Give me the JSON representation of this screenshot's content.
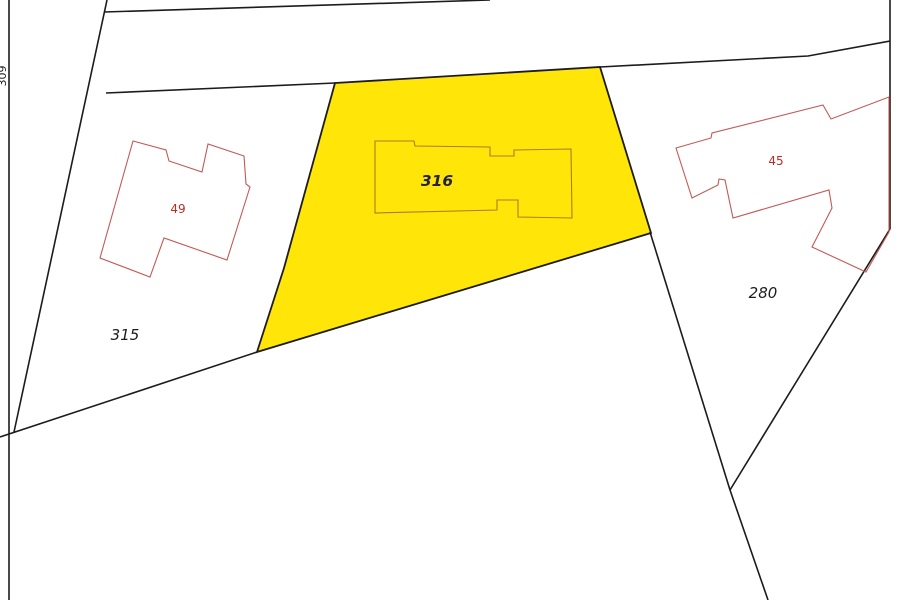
{
  "map": {
    "background": "#ffffff",
    "colors": {
      "boundary": "#1c1c1c",
      "highlight_fill": "#ffe608",
      "building_outline": "#c25a56",
      "building_outline_on_highlight": "#a97d22",
      "building_label": "#bb2d23",
      "parcel_label": "#1c1c1c",
      "highlight_parcel_label": "#23233f"
    },
    "parcels": [
      {
        "name": "parcel-316-highlighted",
        "label": "316",
        "fill": "#ffe608",
        "stroke": "#1c1c1c",
        "stroke_width": 1.8,
        "interactable": true,
        "points": [
          [
            335,
            83
          ],
          [
            600,
            67
          ],
          [
            651,
            233
          ],
          [
            257,
            352
          ],
          [
            284,
            268
          ]
        ]
      },
      {
        "name": "parcel-315",
        "label": "315",
        "fill": "transparent",
        "stroke": "none",
        "stroke_width": 0,
        "interactable": true,
        "points": [
          [
            106,
            93
          ],
          [
            335,
            83
          ],
          [
            284,
            268
          ],
          [
            257,
            352
          ],
          [
            14,
            432
          ]
        ]
      },
      {
        "name": "parcel-280",
        "label": "280",
        "fill": "transparent",
        "stroke": "none",
        "stroke_width": 0,
        "interactable": true,
        "points": [
          [
            600,
            67
          ],
          [
            808,
            56
          ],
          [
            890,
            41
          ],
          [
            890,
            229
          ],
          [
            730,
            490
          ],
          [
            650,
            232
          ]
        ]
      }
    ],
    "boundaries": [
      {
        "name": "boundary-left-border",
        "points": [
          [
            9,
            0
          ],
          [
            9,
            600
          ]
        ]
      },
      {
        "name": "boundary-left-steep-line",
        "points": [
          [
            107,
            0
          ],
          [
            14,
            432
          ]
        ]
      },
      {
        "name": "boundary-top-line",
        "points": [
          [
            104,
            12
          ],
          [
            490,
            0
          ]
        ]
      },
      {
        "name": "boundary-parcel315-top",
        "points": [
          [
            106,
            93
          ],
          [
            335,
            83
          ]
        ]
      },
      {
        "name": "boundary-bottom-left-diagonal",
        "points": [
          [
            0,
            437
          ],
          [
            257,
            352
          ]
        ]
      },
      {
        "name": "boundary-apex-to-right",
        "points": [
          [
            600,
            67
          ],
          [
            808,
            56
          ],
          [
            890,
            41
          ]
        ]
      },
      {
        "name": "boundary-right-border",
        "points": [
          [
            890,
            0
          ],
          [
            890,
            229
          ]
        ]
      },
      {
        "name": "boundary-right-diagonal",
        "points": [
          [
            890,
            229
          ],
          [
            730,
            490
          ]
        ]
      },
      {
        "name": "boundary-parcel280-left",
        "points": [
          [
            650,
            232
          ],
          [
            730,
            490
          ]
        ]
      },
      {
        "name": "boundary-bottom-continuation",
        "points": [
          [
            730,
            490
          ],
          [
            768,
            600
          ]
        ]
      }
    ],
    "buildings": [
      {
        "name": "building-316-outline",
        "stroke": "#a97d22",
        "points": [
          [
            375,
            141
          ],
          [
            414,
            141
          ],
          [
            415,
            146
          ],
          [
            490,
            147
          ],
          [
            490,
            156
          ],
          [
            514,
            156
          ],
          [
            514,
            150
          ],
          [
            571,
            149
          ],
          [
            572,
            218
          ],
          [
            518,
            217
          ],
          [
            518,
            200
          ],
          [
            497,
            200
          ],
          [
            497,
            210
          ],
          [
            375,
            213
          ]
        ]
      },
      {
        "name": "building-49-outline",
        "stroke": "#c25a56",
        "points": [
          [
            133,
            141
          ],
          [
            166,
            150
          ],
          [
            169,
            161
          ],
          [
            202,
            172
          ],
          [
            208,
            144
          ],
          [
            244,
            156
          ],
          [
            246,
            184
          ],
          [
            250,
            187
          ],
          [
            227,
            260
          ],
          [
            164,
            238
          ],
          [
            150,
            277
          ],
          [
            100,
            258
          ]
        ]
      },
      {
        "name": "building-45-outline",
        "stroke": "#c25a56",
        "points": [
          [
            676,
            148
          ],
          [
            711,
            138
          ],
          [
            712,
            133
          ],
          [
            823,
            105
          ],
          [
            831,
            119
          ],
          [
            889,
            97
          ],
          [
            889,
            232
          ],
          [
            866,
            272
          ],
          [
            812,
            247
          ],
          [
            832,
            208
          ],
          [
            829,
            190
          ],
          [
            733,
            218
          ],
          [
            725,
            180
          ],
          [
            719,
            179
          ],
          [
            718,
            185
          ],
          [
            692,
            198
          ]
        ]
      }
    ],
    "labels": [
      {
        "name": "parcel-label-316",
        "text": "316",
        "x": 437,
        "y": 186,
        "color": "#23233f",
        "size": 15.5,
        "italic": true,
        "weight": "bold",
        "rotate": 0
      },
      {
        "name": "parcel-label-315",
        "text": "315",
        "x": 125,
        "y": 340,
        "color": "#1c1c1c",
        "size": 15,
        "italic": true,
        "weight": "normal",
        "rotate": 0
      },
      {
        "name": "parcel-label-280",
        "text": "280",
        "x": 763,
        "y": 298,
        "color": "#1c1c1c",
        "size": 15,
        "italic": true,
        "weight": "normal",
        "rotate": 0
      },
      {
        "name": "building-label-49",
        "text": "49",
        "x": 178,
        "y": 213,
        "color": "#bb2d23",
        "size": 12,
        "italic": false,
        "weight": "normal",
        "rotate": 0
      },
      {
        "name": "building-label-45",
        "text": "45",
        "x": 776,
        "y": 165,
        "color": "#bb2d23",
        "size": 12,
        "italic": false,
        "weight": "normal",
        "rotate": 0
      },
      {
        "name": "parcel-label-309",
        "text": "309",
        "x": 6,
        "y": 76,
        "color": "#1c1c1c",
        "size": 11,
        "italic": false,
        "weight": "normal",
        "rotate": -90
      }
    ]
  }
}
